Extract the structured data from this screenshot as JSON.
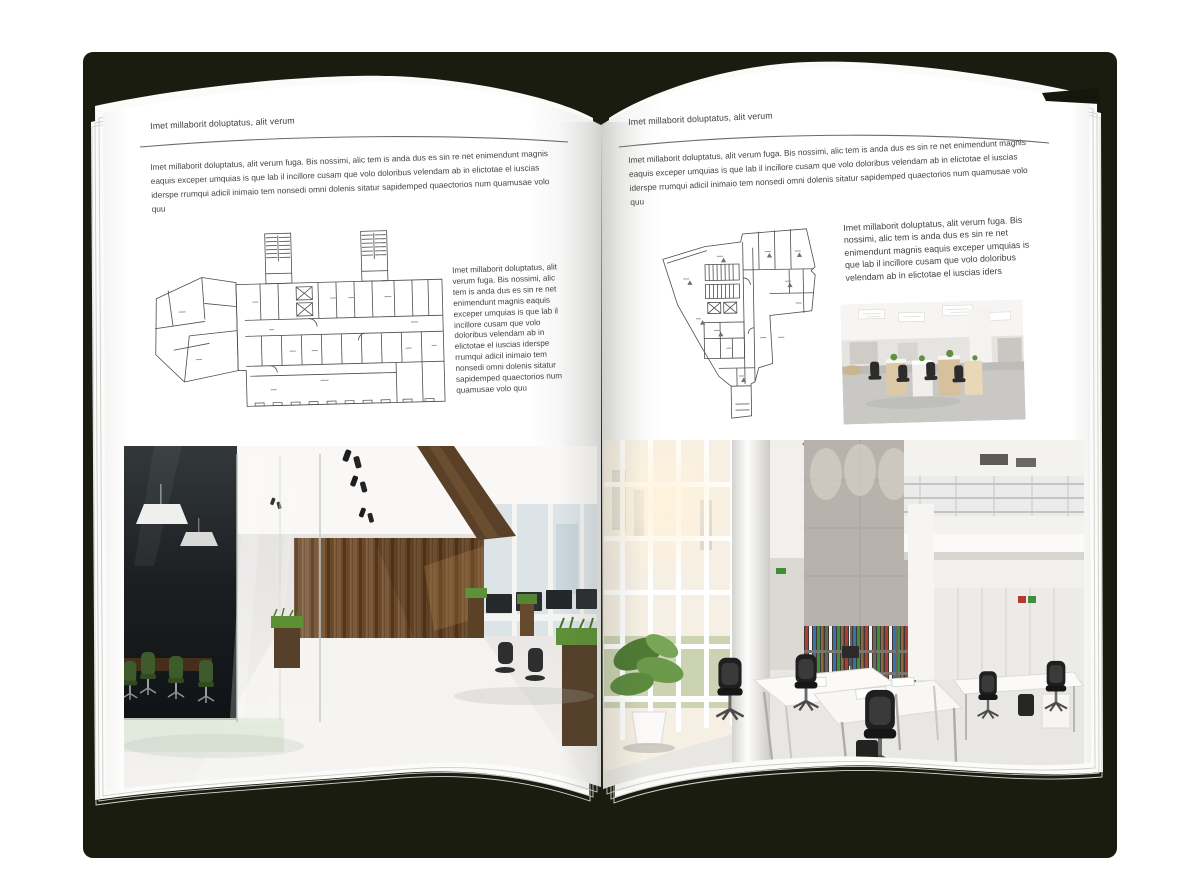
{
  "mockup": {
    "type": "open-magazine-spread",
    "palette": {
      "backdrop_cover": "#1a1c0f",
      "page": "#ffffff",
      "text": "#3e3e3e",
      "plan_line": "#4c4c4c",
      "wood": "#6a4a2e",
      "chair_green": "#3e5c2b"
    }
  },
  "left_page": {
    "header": "Imet millaborit doluptatus, alit verum",
    "intro": "Imet millaborit doluptatus, alit verum fuga. Bis nossimi, alic tem is anda dus es sin re net enimendunt magnis eaquis exceper umquias is que lab il incillore cusam que volo doloribus velendam ab in elictotae el iuscias iderspe rrumqui adicil inimaio tem nonsedi omni dolenis sitatur sapidemped quaectorios num quamusae volo quu",
    "side_text": "Imet millaborit doluptatus, alit verum fuga. Bis nossimi, alic tem is anda dus es sin re net enimendunt magnis eaquis exceper umquias is que lab il incillore cusam que volo doloribus velendam ab in elictotae el iuscias iderspe rrumqui adicil inimaio tem nonsedi omni dolenis sitatur sapidemped quaectorios num quamusae volo quu",
    "floor_plan": "wide-building-floor-plan",
    "photo": "office-interior-wood-glass-meeting-room"
  },
  "right_page": {
    "header": "Imet millaborit doluptatus, alit verum",
    "intro": "Imet millaborit doluptatus, alit verum fuga. Bis nossimi, alic tem is anda dus es sin re net enimendunt magnis eaquis exceper umquias is que lab il incillore cusam que volo doloribus velendam ab in elictotae el iuscias iderspe rrumqui adicil inimaio tem nonsedi omni dolenis sitatur sapidemped quaectorios num quamusae volo quu",
    "side_text": "Imet millaborit doluptatus, alit verum fuga. Bis nossimi, alic tem is anda dus es sin re net enimendunt magnis eaquis exceper umquias is que lab il incillore cusam que volo doloribus velendam ab in elictotae el iuscias iders",
    "floor_plan": "irregular-tower-floor-plan",
    "photo_small": "bright-open-office-cubicles",
    "photo": "white-atrium-office-interior"
  }
}
